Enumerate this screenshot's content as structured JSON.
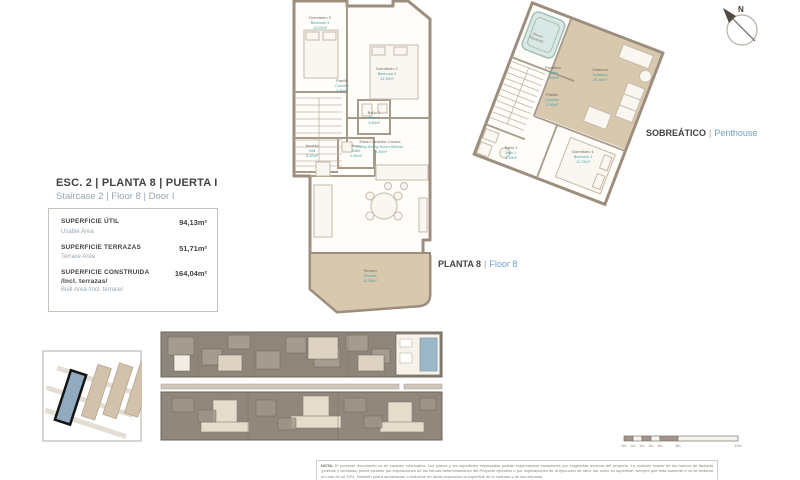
{
  "compass": {
    "n": "N"
  },
  "left_panel": {
    "title_es": "ESC. 2 | PLANTA 8 | PUERTA I",
    "title_en": "Staircase 2 | Floor 8 | Door I",
    "rows": [
      {
        "label_es": "SUPERFICIE ÚTIL",
        "label_en": "Usable Area",
        "value": "94,13m²"
      },
      {
        "label_es": "SUPERFICIE TERRAZAS",
        "label_en": "Terrace Area",
        "value": "51,71m²"
      },
      {
        "label_es": "SUPERFICIE CONSTRUIDA",
        "label_es_2": "/Incl. terrazas/",
        "label_en": "Built Area /Incl. terrace/",
        "value": "164,04m²"
      }
    ]
  },
  "floor_labels": {
    "planta8_es": "PLANTA 8",
    "planta8_sep": "|",
    "planta8_en": "Floor 8",
    "sobreatico_es": "SOBREÁTICO",
    "sobreatico_sep": "|",
    "sobreatico_en": "Penthouse"
  },
  "floor8_plan": {
    "rooms": [
      {
        "es": "Dormitorio 3",
        "en": "Bedroom 3",
        "area": "12,02m²"
      },
      {
        "es": "Dormitorio 2",
        "en": "Bedroom 2",
        "area": "13,39m²"
      },
      {
        "es": "Pasillo",
        "en": "Corridor",
        "area": "3,40m²"
      },
      {
        "es": "Baño 2",
        "en": "Bath 2",
        "area": "3,80m²"
      },
      {
        "es": "Acceso",
        "en": "Hall",
        "area": "5,20m²"
      },
      {
        "es": "Aseo",
        "en": "Toilet",
        "area": "2,85m²"
      },
      {
        "es": "Estar-Comedor-Cocina",
        "en": "Living-Dining Room-Kitchen",
        "area": "28,46m²"
      },
      {
        "es": "Terraza",
        "en": "Terrace",
        "area": "12,36m²"
      }
    ]
  },
  "penthouse_plan": {
    "rooms": [
      {
        "es": "Jacuzzi",
        "en": "(Opcional)"
      },
      {
        "es": "Solárium",
        "en": "Solarium",
        "area": "39,35m²"
      },
      {
        "es": "Escalera",
        "en": "Stairs",
        "area": "7,04m²"
      },
      {
        "es": "Pasillo",
        "en": "Corridor",
        "area": "2,06m²"
      },
      {
        "es": "Baño 1",
        "en": "Bath 1",
        "area": "4,19m²"
      },
      {
        "es": "Dormitorio 1",
        "en": "Bedroom 1",
        "area": "11,72m²"
      }
    ]
  },
  "scale_bar": {
    "ticks": [
      "0m",
      "1m",
      "2m",
      "3m",
      "4m",
      "5m",
      "10m"
    ]
  },
  "footnote": {
    "label": "NOTA:",
    "text": "El presente documento es de carácter informativo. Los planos y las superficies expresadas podrán experimentar variaciones por exigencias técnicas del proyecto. La posición exacta de los huecos de fachada (puertas y ventanas) podrá variarse por imposiciones de las futuras determinaciones del Proyecto ejecutivo o por implicaciones de la ejecución de obra, así como su superficie, siempre que ésta aumente o no se reduzca en más de un 10%. También podrá aumentarse o reducirse en dicha proporción la superficie de la vivienda y de sus terrazas."
  }
}
